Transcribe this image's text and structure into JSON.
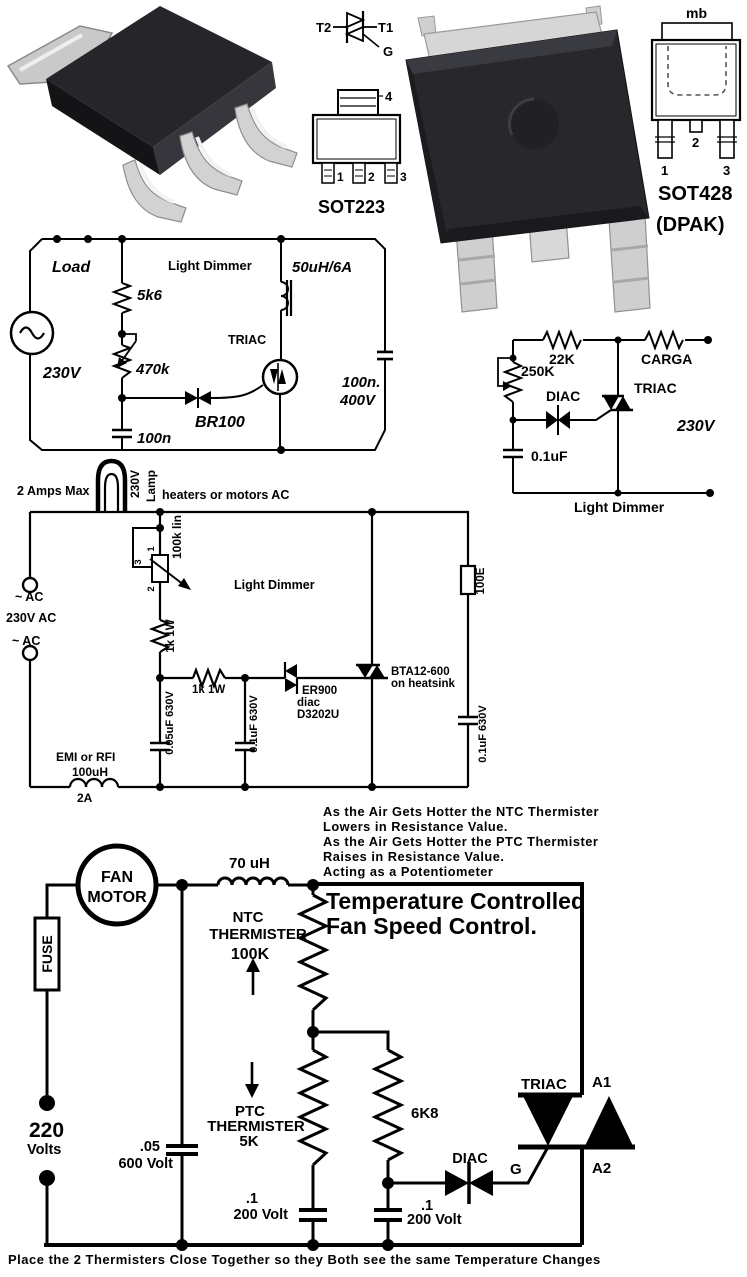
{
  "colors": {
    "ink": "#000000",
    "paper": "#ffffff",
    "chip_body": "#26262b",
    "metal": "#d2d2d2"
  },
  "pkg": {
    "triac_sym": {
      "t2": "T2",
      "t1": "T1",
      "g": "G"
    },
    "sot223": {
      "name": "SOT223",
      "pin1": "1",
      "pin2": "2",
      "pin3": "3",
      "pin4": "4"
    },
    "sot428": {
      "name": "SOT428",
      "variant": "(DPAK)",
      "tab": "mb",
      "pin1": "1",
      "pin2": "2",
      "pin3": "3"
    }
  },
  "d1": {
    "title": "Light Dimmer",
    "load": "Load",
    "voltage": "230V",
    "r1": "5k6",
    "pot": "470k",
    "cap_bottom": "100n",
    "diac": "BR100",
    "triac": "TRIAC",
    "inductor": "50uH/6A",
    "cap_right1": "100n.",
    "cap_right2": "400V"
  },
  "d2": {
    "caption": "Light Dimmer",
    "r1": "22K",
    "load": "CARGA",
    "pot": "250K",
    "diac": "DIAC",
    "triac": "TRIAC",
    "voltage": "230V",
    "cap": "0.1uF"
  },
  "d3": {
    "title": "Light Dimmer",
    "amps": "2 Amps Max",
    "lamp1": "230V",
    "lamp2": "Lamp",
    "heaters": "heaters or motors AC",
    "ac_top": "~ AC",
    "ac_voltage": "230V AC",
    "ac_bottom": "~ AC",
    "pot": "100k lin",
    "pot_p1": "1",
    "pot_p2": "2",
    "pot_p3": "3",
    "r_top": "1k 1W",
    "r_mid": "1k 1W",
    "diac1": "ER900",
    "diac2": "diac",
    "diac3": "D3202U",
    "triac1": "BTA12-600",
    "triac2": "on heatsink",
    "r_right": "100E",
    "cap_left": "0.05uF 630V",
    "cap_mid": "0.1uF 630V",
    "cap_right": "0.1uF 630V",
    "emi1": "EMI or RFI",
    "emi2": "100uH",
    "emi3": "2A"
  },
  "fan": {
    "note_lines": [
      "As the Air Gets Hotter the NTC Thermister",
      "Lowers in Resistance Value.",
      "As the Air Gets Hotter the PTC Thermister",
      "Raises in Resistance Value.",
      "Acting as a Potentiometer"
    ],
    "title1": "Temperature Controlled",
    "title2": "Fan Speed Control.",
    "motor1": "FAN",
    "motor2": "MOTOR",
    "fuse": "FUSE",
    "inductor": "70 uH",
    "ntc1": "NTC",
    "ntc2": "THERMISTER",
    "ntc3": "100K",
    "ptc1": "PTC",
    "ptc2": "THERMISTER",
    "ptc3": "5K",
    "supply1": "220",
    "supply2": "Volts",
    "cap1a": ".05",
    "cap1b": "600 Volt",
    "r1": "6K8",
    "cap2a": ".1",
    "cap2b": "200 Volt",
    "cap3a": ".1",
    "cap3b": "200 Volt",
    "diac": "DIAC",
    "triac": "TRIAC",
    "a1": "A1",
    "a2": "A2",
    "g": "G",
    "caption": "Place the 2 Thermisters Close Together so they Both see the same Temperature Changes"
  }
}
